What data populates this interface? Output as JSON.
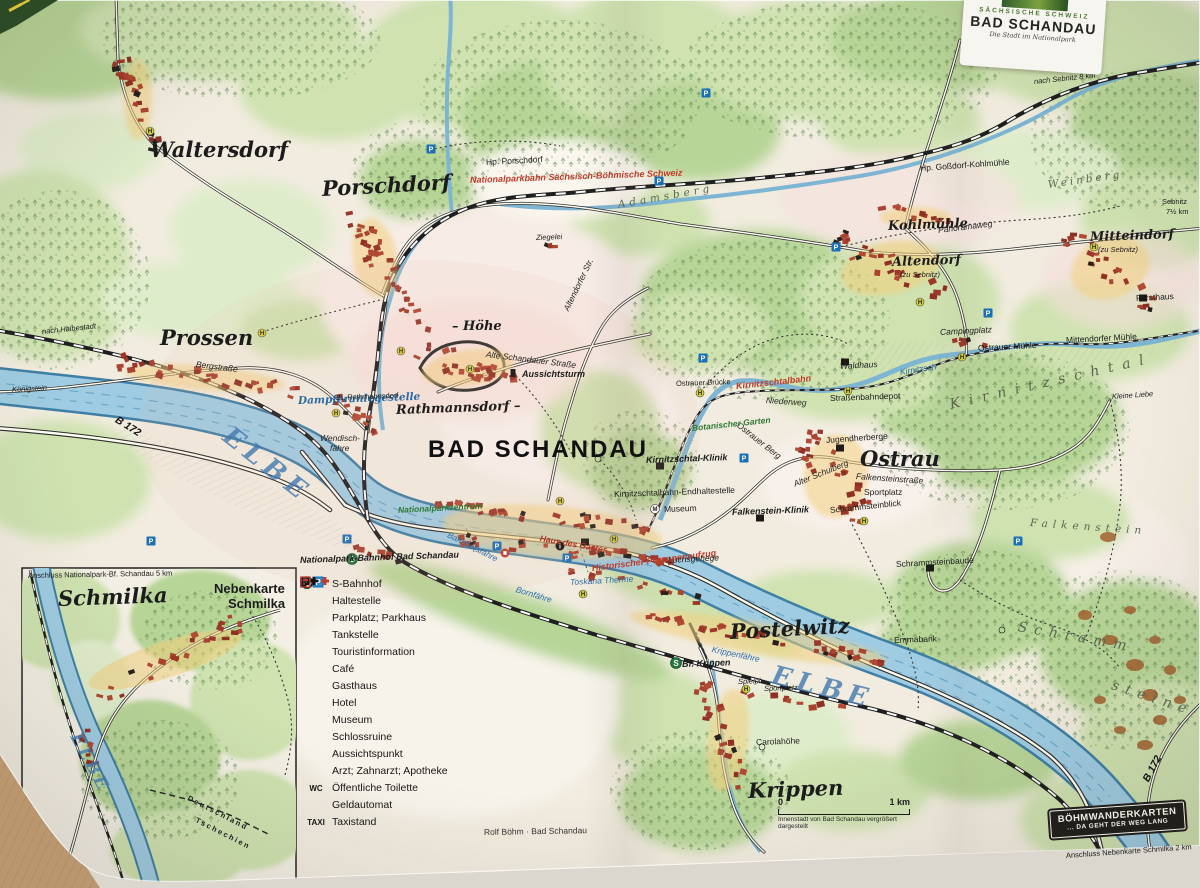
{
  "title_card": {
    "region": "SÄCHSISCHE SCHWEIZ",
    "title": "BAD SCHANDAU",
    "subtitle": "Die Stadt im Nationalpark"
  },
  "badge": {
    "line1": "BÖHMWANDERKARTEN",
    "line2": "... DA GEHT DER WEG LANG"
  },
  "scale_bar": {
    "start": "0",
    "end": "1 km",
    "note": "Innenstadt von Bad Schandau vergrößert dargestellt"
  },
  "colors": {
    "paper": "#f1ecdf",
    "water_fill": "#9fcce2",
    "water_edge": "#3f7fa5",
    "forest": "#b8d598",
    "building_red": "#9c382a",
    "rail_red": "#c23b2a",
    "sbahn_green": "#1f7a3c",
    "parking_blue": "#1a6fb5",
    "haltestelle_yellow": "#d8d23a"
  },
  "legend": {
    "items": [
      {
        "icon": "s-bahn",
        "label": "S-Bahnhof"
      },
      {
        "icon": "haltestelle",
        "label": "Haltestelle"
      },
      {
        "icon": "parkplatz",
        "label": "Parkplatz; Parkhaus"
      },
      {
        "icon": "tankstelle",
        "label": "Tankstelle"
      },
      {
        "icon": "touristinformation",
        "label": "Touristinformation"
      },
      {
        "icon": "cafe",
        "label": "Café"
      },
      {
        "icon": "gasthaus",
        "label": "Gasthaus"
      },
      {
        "icon": "hotel",
        "label": "Hotel"
      },
      {
        "icon": "museum",
        "label": "Museum"
      },
      {
        "icon": "schlossruine",
        "label": "Schlossruine"
      },
      {
        "icon": "aussichtspunkt",
        "label": "Aussichtspunkt"
      },
      {
        "icon": "arzt",
        "label": "Arzt; Zahnarzt; Apotheke"
      },
      {
        "icon": "wc",
        "label": "Öffentliche Toilette"
      },
      {
        "icon": "geldautomat",
        "label": "Geldautomat"
      },
      {
        "icon": "taxi",
        "label": "Taxistand"
      }
    ]
  },
  "map_labels": [
    {
      "t": "Waltersdorf",
      "x": 150,
      "y": 139,
      "cls": "town-lg"
    },
    {
      "t": "Porschdorf",
      "x": 322,
      "y": 178,
      "cls": "town-lg",
      "rot": -3
    },
    {
      "t": "Prossen",
      "x": 160,
      "y": 327,
      "cls": "town-lg"
    },
    {
      "t": "Ostrau",
      "x": 860,
      "y": 448,
      "cls": "town-lg"
    },
    {
      "t": "Postelwitz",
      "x": 730,
      "y": 621,
      "cls": "town-lg",
      "rot": -3
    },
    {
      "t": "Krippen",
      "x": 748,
      "y": 780,
      "cls": "town-lg",
      "rot": -2
    },
    {
      "t": "Schmilka",
      "x": 58,
      "y": 588,
      "cls": "town-lg",
      "rot": -2
    },
    {
      "t": "BAD SCHANDAU",
      "x": 428,
      "y": 438,
      "cls": "town-xl"
    },
    {
      "t": "Rathmannsdorf –",
      "x": 396,
      "y": 404,
      "cls": "town-md-i",
      "rot": -2
    },
    {
      "t": "– Höhe",
      "x": 452,
      "y": 320,
      "cls": "town-md-i"
    },
    {
      "t": "Altendorf",
      "x": 892,
      "y": 256,
      "cls": "town-md",
      "rot": -2
    },
    {
      "t": "(zu Sebnitz)",
      "x": 900,
      "y": 271,
      "cls": "tiny-i"
    },
    {
      "t": "Mitteindorf",
      "x": 1090,
      "y": 231,
      "cls": "town-md",
      "rot": -2
    },
    {
      "t": "(zu Sebnitz)",
      "x": 1098,
      "y": 246,
      "cls": "tiny-i"
    },
    {
      "t": "Kohlmühle",
      "x": 888,
      "y": 220,
      "cls": "town-md",
      "rot": -2
    },
    {
      "t": "ELBE",
      "x": 226,
      "y": 420,
      "cls": "water-big",
      "rot": 38
    },
    {
      "t": "ELBE",
      "x": 772,
      "y": 662,
      "cls": "water-big",
      "rot": 14
    },
    {
      "t": "ELBE",
      "x": 74,
      "y": 726,
      "cls": "water-big-sm",
      "rot": 62
    },
    {
      "t": "Dampferanlegestelle",
      "x": 298,
      "y": 396,
      "cls": "water",
      "rot": -2
    },
    {
      "t": "Bahnhofsfähre",
      "x": 448,
      "y": 530,
      "cls": "water-sm",
      "rot": 27
    },
    {
      "t": "Bornfähre",
      "x": 516,
      "y": 585,
      "cls": "water-sm",
      "rot": 17
    },
    {
      "t": "Krippenfähre",
      "x": 712,
      "y": 645,
      "cls": "water-sm",
      "rot": 12
    },
    {
      "t": "Wendisch-",
      "x": 320,
      "y": 434,
      "cls": "street-i"
    },
    {
      "t": "fähre",
      "x": 330,
      "y": 444,
      "cls": "street-i"
    },
    {
      "t": "Bf. Rathmannsdorf",
      "x": 336,
      "y": 394,
      "cls": "tiny",
      "rot": -2
    },
    {
      "t": "B 172",
      "x": 116,
      "y": 414,
      "cls": "road-num",
      "rot": 32
    },
    {
      "t": "B 172",
      "x": 1146,
      "y": 776,
      "cls": "road-num",
      "rot": -62
    },
    {
      "t": "Nationalparkbahn Sächsisch-Böhmische Schweiz",
      "x": 470,
      "y": 176,
      "cls": "rail-red",
      "rot": -2
    },
    {
      "t": "Kirnitzschtalbahn",
      "x": 736,
      "y": 382,
      "cls": "rail-red",
      "rot": -6
    },
    {
      "t": "Historischer Personenaufzug",
      "x": 592,
      "y": 564,
      "cls": "rail-red",
      "rot": -7
    },
    {
      "t": "Nationalparkzentrum",
      "x": 398,
      "y": 506,
      "cls": "green-i",
      "rot": -3
    },
    {
      "t": "Toskana Therme",
      "x": 570,
      "y": 578,
      "cls": "water-sm",
      "rot": -3
    },
    {
      "t": "Luchsgehege",
      "x": 668,
      "y": 556,
      "cls": "poi-i",
      "rot": -3
    },
    {
      "t": "Haus des Gastes",
      "x": 540,
      "y": 534,
      "cls": "poi-red",
      "rot": 10
    },
    {
      "t": "Nationalpark-Bahnhof Bad Schandau",
      "x": 300,
      "y": 556,
      "cls": "poi-b",
      "rot": -2
    },
    {
      "t": "Hp. Porschdorf",
      "x": 486,
      "y": 158,
      "cls": "poi",
      "rot": -3
    },
    {
      "t": "Hp. Goßdorf-Kohlmühle",
      "x": 920,
      "y": 164,
      "cls": "poi",
      "rot": -4
    },
    {
      "t": "Ziegelei",
      "x": 536,
      "y": 234,
      "cls": "tiny-i",
      "rot": -2
    },
    {
      "t": "Adamsberg",
      "x": 618,
      "y": 200,
      "cls": "area",
      "rot": -10,
      "sp": 4
    },
    {
      "t": "Panoramaweg",
      "x": 938,
      "y": 226,
      "cls": "street",
      "rot": -7
    },
    {
      "t": "Weinberg",
      "x": 1048,
      "y": 180,
      "cls": "area",
      "rot": -8,
      "sp": 3
    },
    {
      "t": "nach Sebnitz 8 km",
      "x": 1034,
      "y": 78,
      "cls": "tiny-i",
      "rot": -6
    },
    {
      "t": "Sebnitz",
      "x": 1162,
      "y": 198,
      "cls": "tiny"
    },
    {
      "t": "7½ km",
      "x": 1166,
      "y": 208,
      "cls": "tiny"
    },
    {
      "t": "Alte Schandauer Straße",
      "x": 486,
      "y": 350,
      "cls": "street",
      "rot": 7
    },
    {
      "t": "Altendorfer Str.",
      "x": 566,
      "y": 306,
      "cls": "street",
      "rot": -64
    },
    {
      "t": "Aussichtsturm",
      "x": 522,
      "y": 370,
      "cls": "poi-b"
    },
    {
      "t": "Bergstraße",
      "x": 196,
      "y": 360,
      "cls": "street",
      "rot": 7
    },
    {
      "t": "nach Halbestadt",
      "x": 42,
      "y": 328,
      "cls": "tiny-i",
      "rot": -6
    },
    {
      "t": "Königstein",
      "x": 12,
      "y": 386,
      "cls": "tiny-i",
      "rot": -3
    },
    {
      "t": "Kirnitzschtal-Klinik",
      "x": 646,
      "y": 456,
      "cls": "poi-b",
      "rot": -2
    },
    {
      "t": "Kirnitzschtalbahn-Endhaltestelle",
      "x": 614,
      "y": 490,
      "cls": "poi",
      "rot": -2
    },
    {
      "t": "Museum",
      "x": 664,
      "y": 505,
      "cls": "poi",
      "rot": -2
    },
    {
      "t": "Falkenstein-Klinik",
      "x": 732,
      "y": 508,
      "cls": "poi-b",
      "rot": -2
    },
    {
      "t": "Jugendherberge",
      "x": 826,
      "y": 436,
      "cls": "poi",
      "rot": -4
    },
    {
      "t": "Alter Schulberg",
      "x": 794,
      "y": 480,
      "cls": "street",
      "rot": -22
    },
    {
      "t": "Falkensteinstraße",
      "x": 856,
      "y": 472,
      "cls": "street",
      "rot": 4
    },
    {
      "t": "Sportplatz",
      "x": 864,
      "y": 488,
      "cls": "poi"
    },
    {
      "t": "Schrammsteinblick",
      "x": 830,
      "y": 506,
      "cls": "poi",
      "rot": -6
    },
    {
      "t": "Schrammsteinbaude",
      "x": 896,
      "y": 560,
      "cls": "poi",
      "rot": -3
    },
    {
      "t": "Campingplatz",
      "x": 940,
      "y": 328,
      "cls": "poi-i",
      "rot": -3
    },
    {
      "t": "Ostrauer Mühle",
      "x": 978,
      "y": 344,
      "cls": "poi",
      "rot": -3
    },
    {
      "t": "Mittendorfer Mühle",
      "x": 1066,
      "y": 336,
      "cls": "poi",
      "rot": -3
    },
    {
      "t": "Forsthaus",
      "x": 1136,
      "y": 294,
      "cls": "poi",
      "rot": -3
    },
    {
      "t": "Waldhaus",
      "x": 840,
      "y": 362,
      "cls": "poi-i",
      "rot": -3
    },
    {
      "t": "Kirnitzsch",
      "x": 900,
      "y": 368,
      "cls": "water-sm",
      "rot": -9
    },
    {
      "t": "Kirnitzschtal",
      "x": 950,
      "y": 398,
      "cls": "area-lg",
      "rot": -13,
      "sp": 9
    },
    {
      "t": "Kleine Liebe",
      "x": 1112,
      "y": 393,
      "cls": "tiny-i",
      "rot": -4
    },
    {
      "t": "Falkenstein",
      "x": 1030,
      "y": 518,
      "cls": "area",
      "rot": 4,
      "sp": 5
    },
    {
      "t": "Schramm",
      "x": 1018,
      "y": 620,
      "cls": "area-lg",
      "rot": 10,
      "sp": 7
    },
    {
      "t": "steine",
      "x": 1112,
      "y": 678,
      "cls": "area-lg",
      "rot": 18,
      "sp": 7
    },
    {
      "t": "Ostrauer Berg",
      "x": 738,
      "y": 420,
      "cls": "street",
      "rot": 38
    },
    {
      "t": "Niederweg",
      "x": 766,
      "y": 396,
      "cls": "street",
      "rot": 4
    },
    {
      "t": "Straßenbahndepot",
      "x": 830,
      "y": 394,
      "cls": "poi",
      "rot": -2
    },
    {
      "t": "Ostrauer Brücke",
      "x": 676,
      "y": 380,
      "cls": "tiny",
      "rot": -2
    },
    {
      "t": "Botanischer Garten",
      "x": 692,
      "y": 424,
      "cls": "green-i",
      "rot": -6
    },
    {
      "t": "Emmabank",
      "x": 894,
      "y": 636,
      "cls": "poi",
      "rot": -2
    },
    {
      "t": "Carolahöhe",
      "x": 756,
      "y": 738,
      "cls": "poi",
      "rot": -2
    },
    {
      "t": "Bf. Krippen",
      "x": 682,
      "y": 660,
      "cls": "poi-b",
      "rot": -2
    },
    {
      "t": "Spielpl.",
      "x": 738,
      "y": 678,
      "cls": "tiny-i",
      "rot": -2
    },
    {
      "t": "Sportplatz",
      "x": 764,
      "y": 685,
      "cls": "tiny-i",
      "rot": -2
    },
    {
      "t": "Deutschland",
      "x": 188,
      "y": 794,
      "cls": "border",
      "rot": 27
    },
    {
      "t": "Tschechien",
      "x": 196,
      "y": 816,
      "cls": "border",
      "rot": 27
    },
    {
      "t": "Nebenkarte",
      "x": 214,
      "y": 582,
      "cls": "inset-h"
    },
    {
      "t": "Schmilka",
      "x": 228,
      "y": 597,
      "cls": "inset-h"
    },
    {
      "t": "Anschluss Nationalpark-Bf. Schandau 5 km",
      "x": 28,
      "y": 572,
      "cls": "tiny",
      "rot": -1
    },
    {
      "t": "Rolf Böhm · Bad Schandau",
      "x": 484,
      "y": 828,
      "cls": "credit",
      "rot": -1
    },
    {
      "t": "Anschluss Nebenkarte Schmilka 2 km",
      "x": 1066,
      "y": 852,
      "cls": "tiny",
      "rot": -4
    }
  ]
}
